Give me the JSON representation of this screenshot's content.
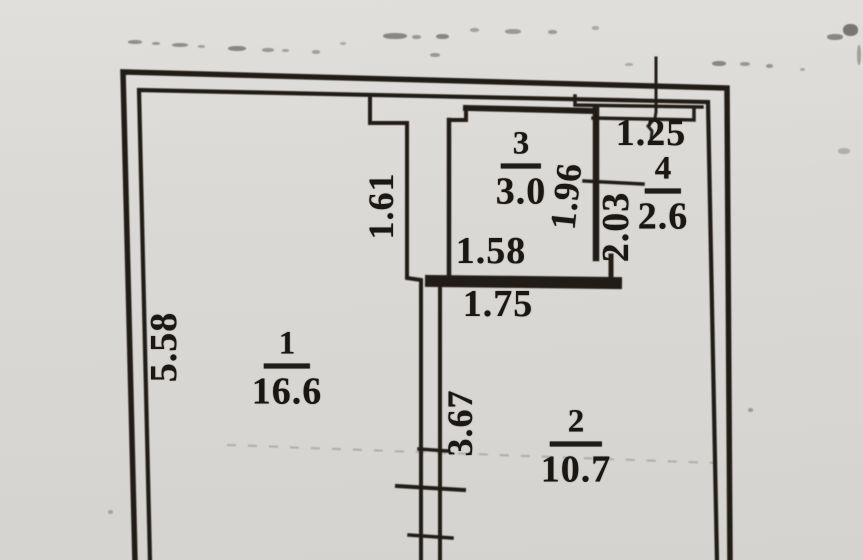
{
  "plan": {
    "rooms": [
      {
        "number": "1",
        "area": "16.6"
      },
      {
        "number": "2",
        "area": "10.7"
      },
      {
        "number": "3",
        "area": "3.0"
      },
      {
        "number": "4",
        "area": "2.6"
      }
    ],
    "dimensions": {
      "outer_left_wall": "5.58",
      "room1_partition_upper": "1.61",
      "room2_partition": "3.67",
      "room3_interior_width": "1.58",
      "room3_bottom_wall": "1.75",
      "room3_right_wall": "1.96",
      "room4_left_wall": "2.03",
      "room4_top_width": "1.25"
    },
    "colors": {
      "paper": "#dbd9d5",
      "ink": "#231f1a"
    }
  }
}
